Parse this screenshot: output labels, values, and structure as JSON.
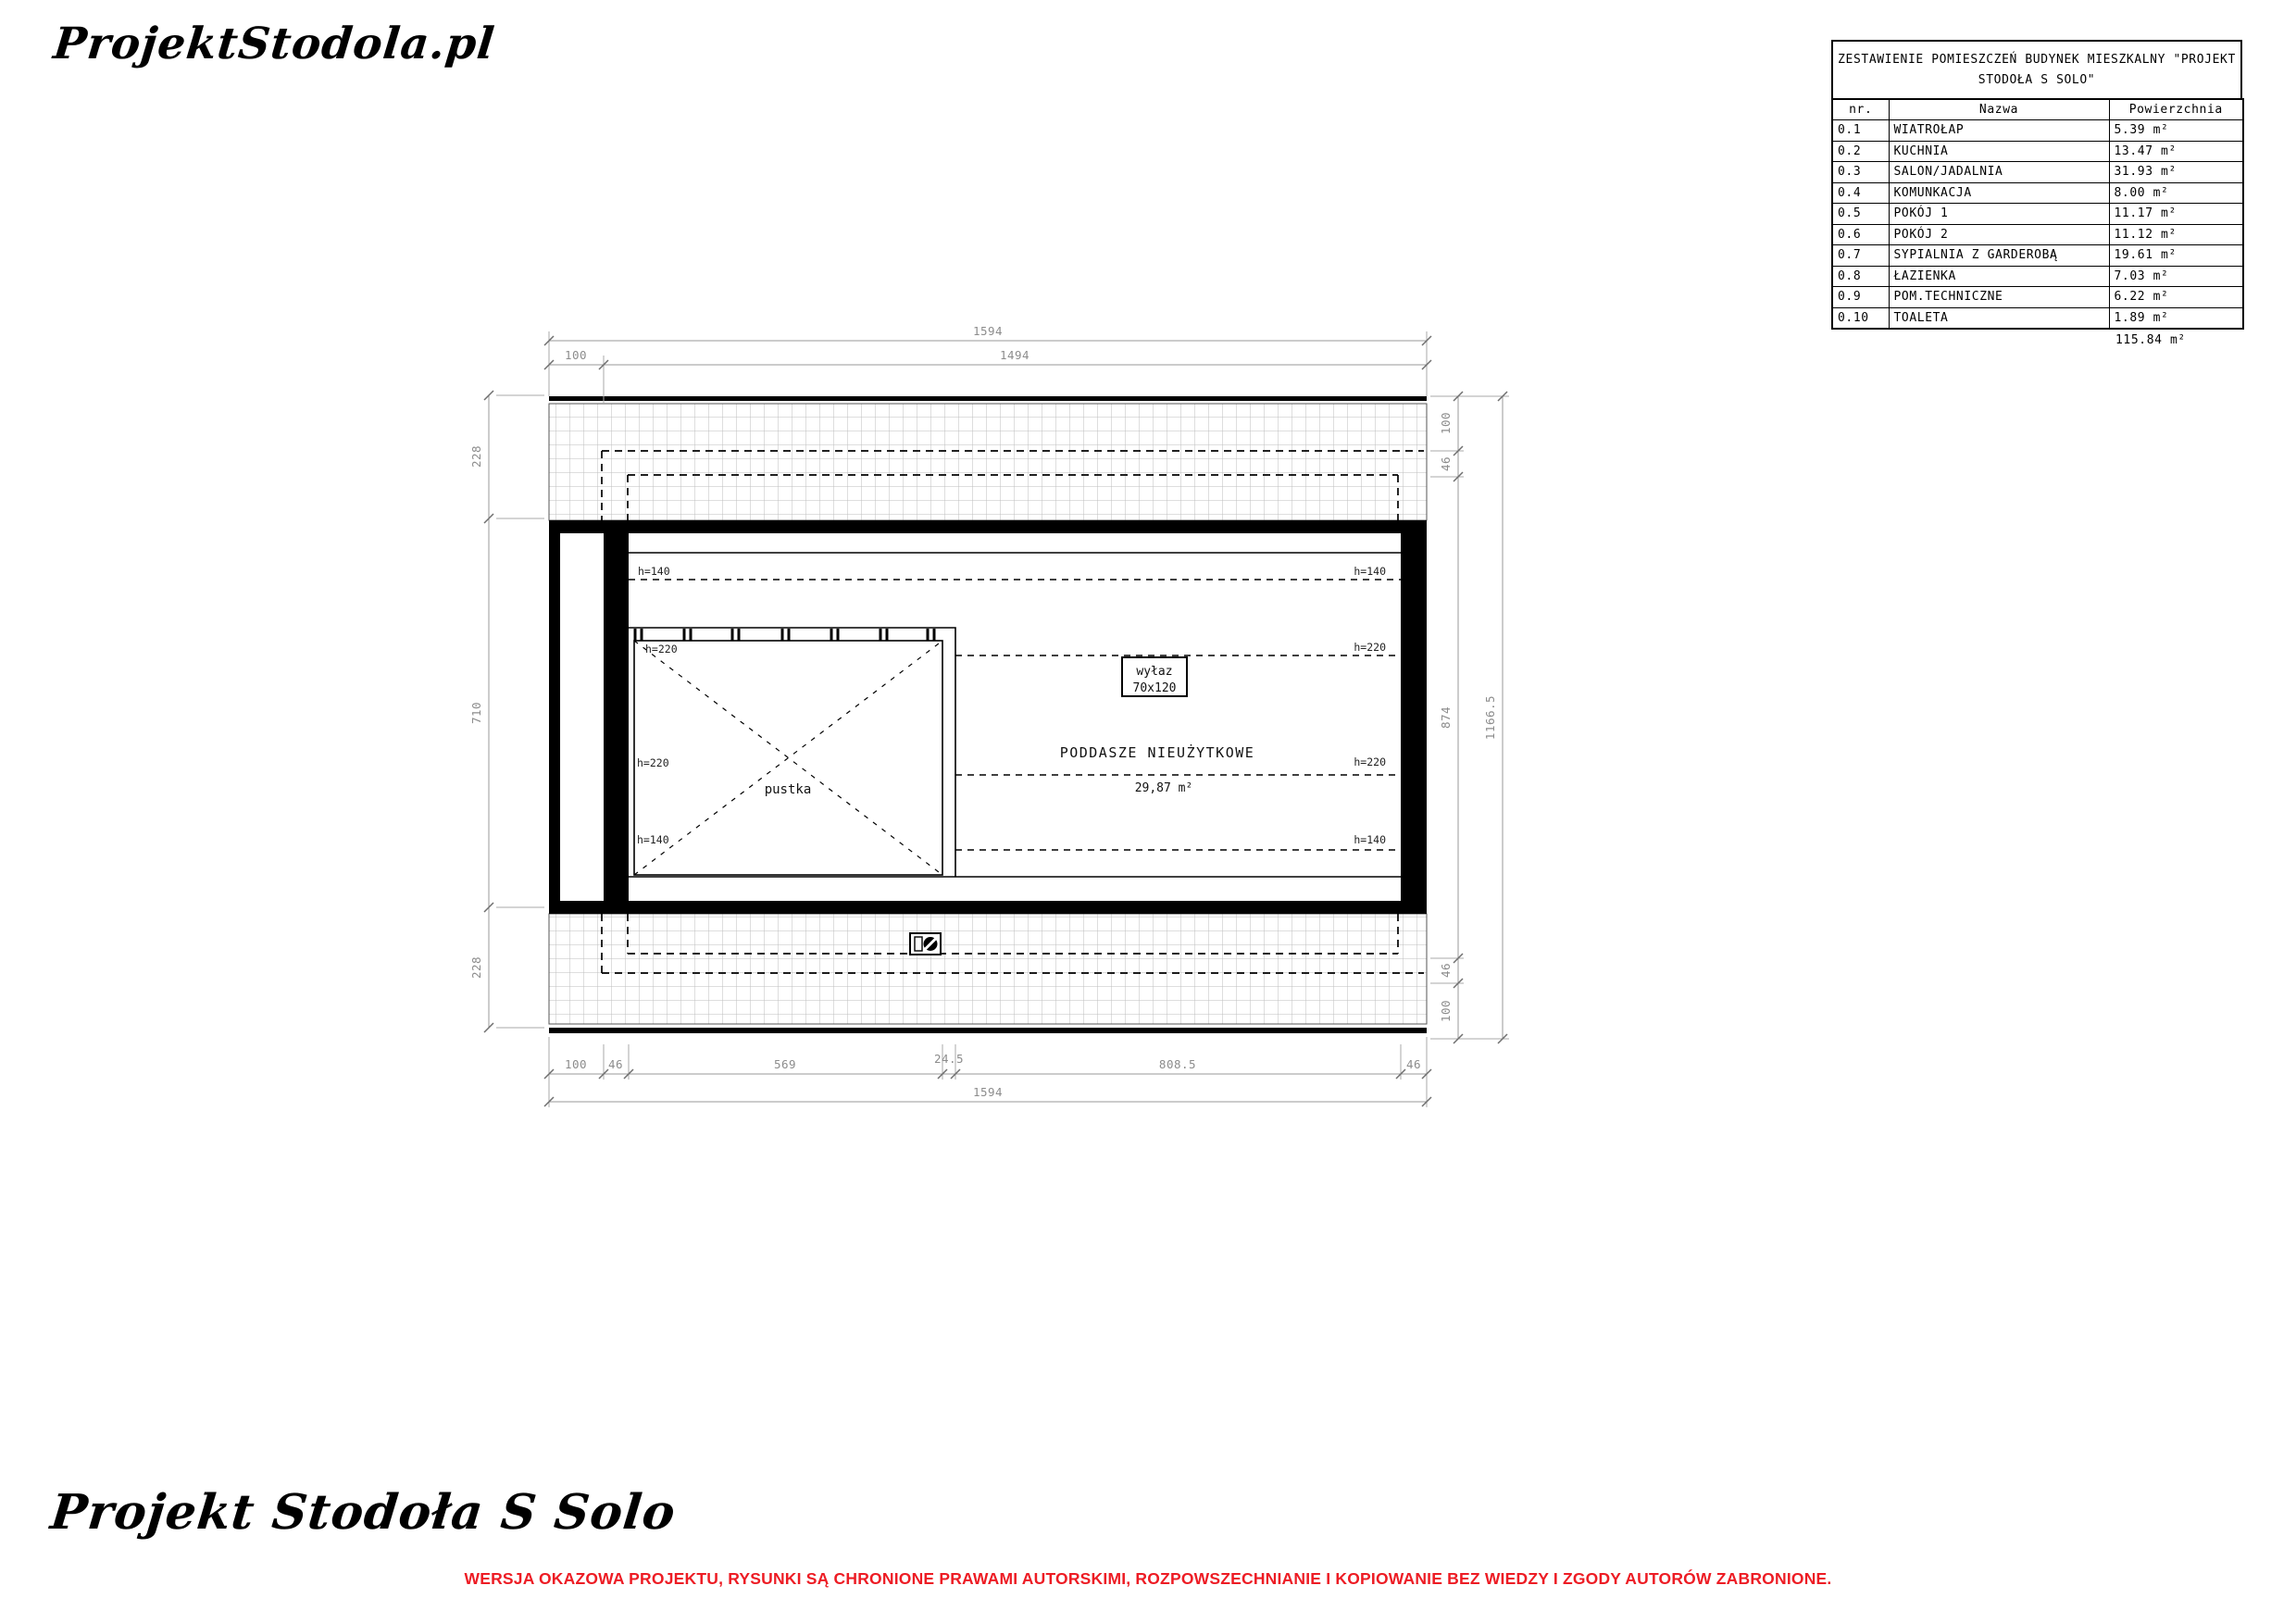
{
  "branding": {
    "logo_top": "ProjektStodola.pl",
    "logo_bottom": "Projekt Stodoła S Solo"
  },
  "footer": {
    "warning": "WERSJA OKAZOWA PROJEKTU, RYSUNKI  SĄ CHRONIONE PRAWAMI AUTORSKIMI, ROZPOWSZECHNIANIE I KOPIOWANIE BEZ WIEDZY I ZGODY AUTORÓW ZABRONIONE.",
    "warning_color": "#ed1c24"
  },
  "room_table": {
    "title_line1": "ZESTAWIENIE POMIESZCZEŃ BUDYNEK MIESZKALNY \"PROJEKT",
    "title_line2": "STODOŁA S SOLO\"",
    "col_nr": "nr.",
    "col_name": "Nazwa",
    "col_area": "Powierzchnia",
    "rows": [
      {
        "nr": "0.1",
        "name": "WIATROŁAP",
        "area": "5.39 m²"
      },
      {
        "nr": "0.2",
        "name": "KUCHNIA",
        "area": "13.47 m²"
      },
      {
        "nr": "0.3",
        "name": "SALON/JADALNIA",
        "area": "31.93 m²"
      },
      {
        "nr": "0.4",
        "name": "KOMUNKACJA",
        "area": "8.00 m²"
      },
      {
        "nr": "0.5",
        "name": "POKÓJ 1",
        "area": "11.17 m²"
      },
      {
        "nr": "0.6",
        "name": "POKÓJ 2",
        "area": "11.12 m²"
      },
      {
        "nr": "0.7",
        "name": "SYPIALNIA Z GARDEROBĄ",
        "area": "19.61 m²"
      },
      {
        "nr": "0.8",
        "name": "ŁAZIENKA",
        "area": "7.03 m²"
      },
      {
        "nr": "0.9",
        "name": "POM.TECHNICZNE",
        "area": "6.22 m²"
      },
      {
        "nr": "0.10",
        "name": "TOALETA",
        "area": "1.89 m²"
      }
    ],
    "total": "115.84 m²"
  },
  "plan": {
    "room_label": "PODDASZE NIEUŻYTKOWE",
    "room_area": "29,87 m²",
    "void_label": "pustka",
    "hatch_line1": "wyłaz",
    "hatch_line2": "70x120",
    "h140": "h=140",
    "h220": "h=220",
    "dims": {
      "top_total": "1594",
      "top_a": "100",
      "top_b": "1494",
      "bottom": [
        "100",
        "46",
        "569",
        "24.5",
        "808.5",
        "46"
      ],
      "bottom_total": "1594",
      "left": [
        "228",
        "710",
        "228"
      ],
      "right": [
        "100",
        "46",
        "874",
        "46",
        "100"
      ],
      "right_total": "1166.5"
    }
  }
}
